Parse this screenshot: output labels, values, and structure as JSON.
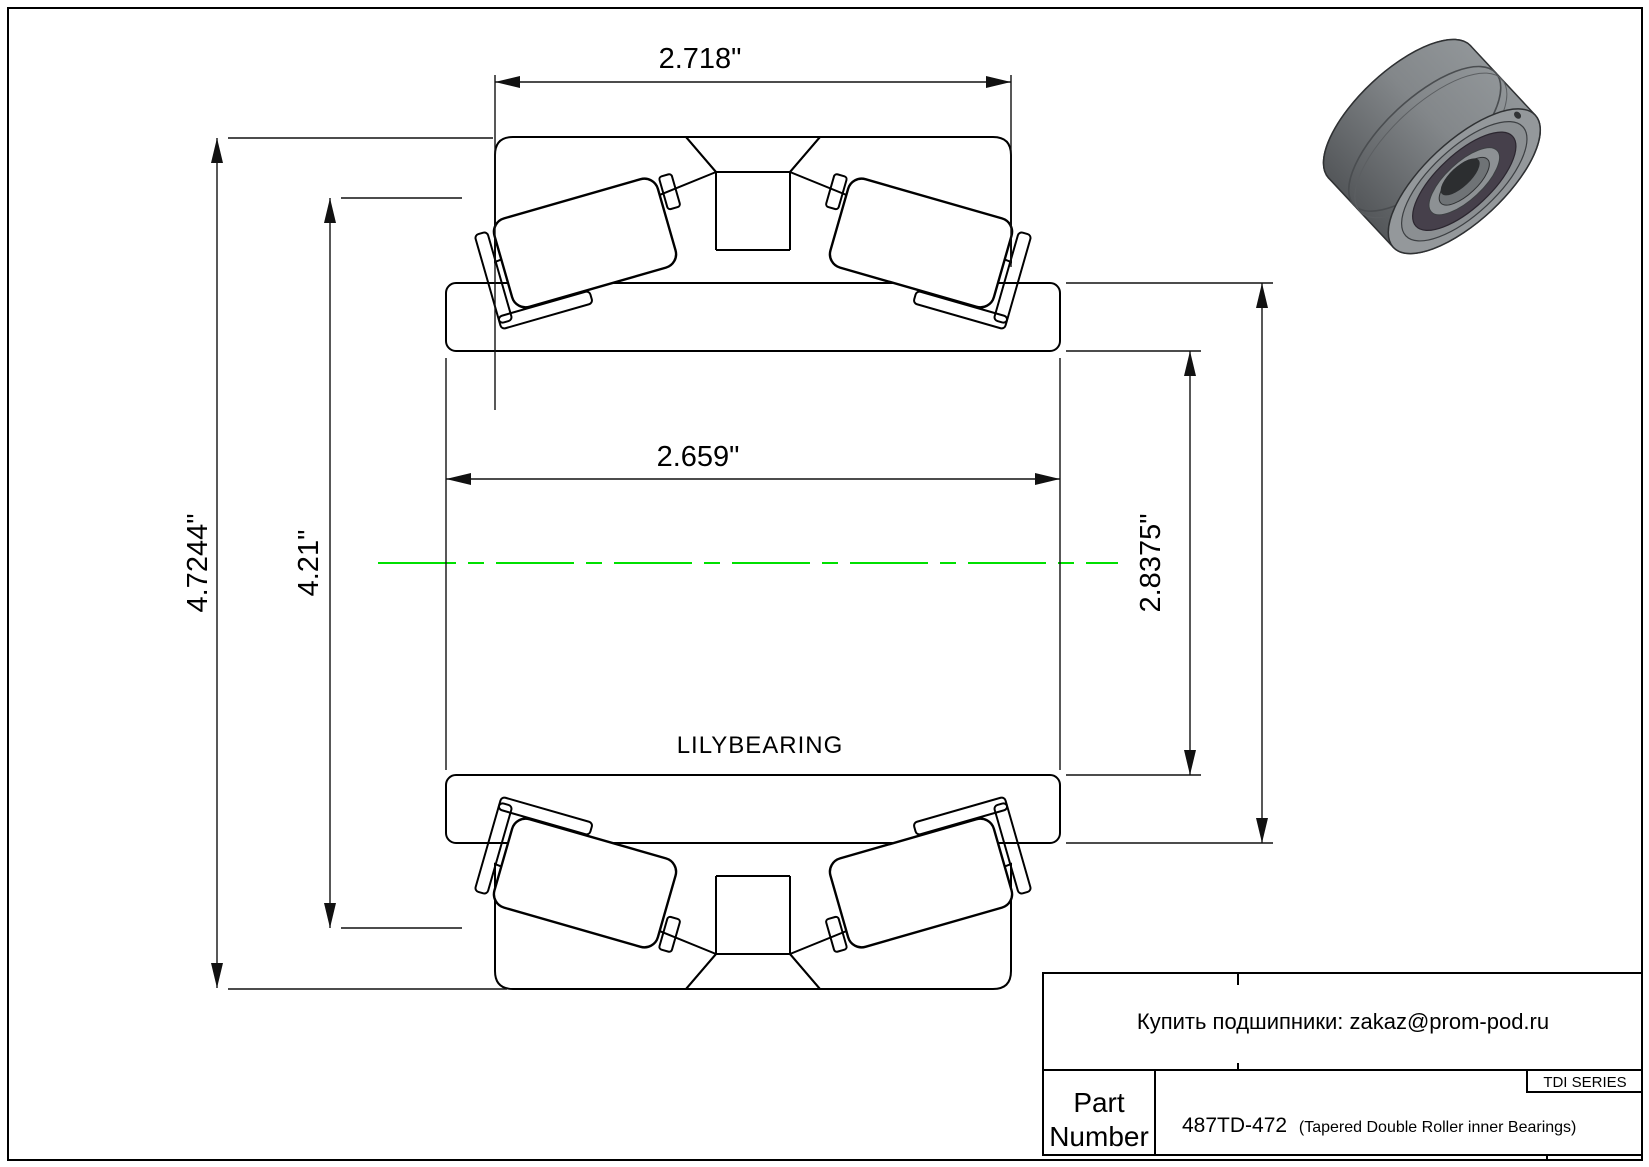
{
  "page": {
    "background": "#ffffff",
    "border_color": "#000000"
  },
  "drawing": {
    "brand_watermark": "LILYBEARING",
    "centerline_color": "#00e000",
    "dimensions": {
      "top_width": "2.718\"",
      "inner_width": "2.659\"",
      "left_outer": "4.7244\"",
      "left_mid": "4.21\"",
      "right_inner": "2.8375\""
    }
  },
  "title_block": {
    "contact_line": "Купить подшипники: zakaz@prom-pod.ru",
    "series_label": "TDI SERIES",
    "part_label_line1": "Part",
    "part_label_line2": "Number",
    "part_number": "487TD-472",
    "part_description": "(Tapered Double Roller inner Bearings)"
  }
}
